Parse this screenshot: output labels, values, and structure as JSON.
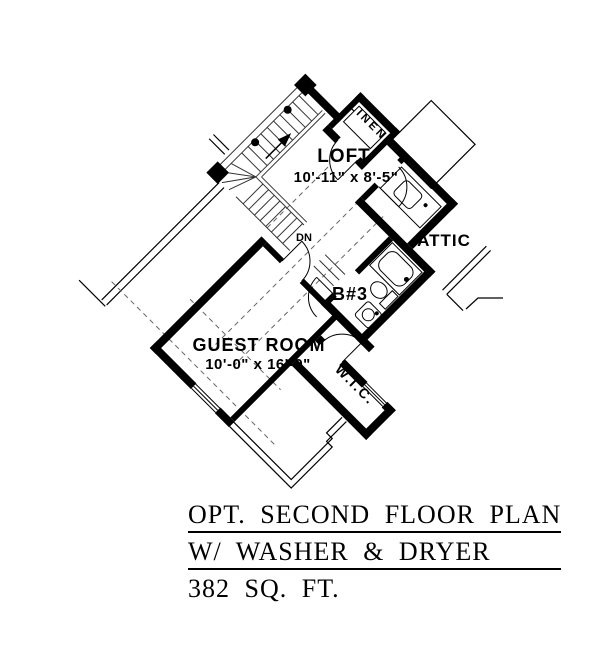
{
  "plan": {
    "rooms": {
      "loft": {
        "label": "LOFT",
        "dims": "10'-11\" x 8'-5\""
      },
      "guest_room": {
        "label": "GUEST ROOM",
        "dims": "10'-0\" x 16'-0\""
      },
      "attic": {
        "label": "ATTIC"
      },
      "bathroom": {
        "label": "B#3"
      },
      "wic": {
        "label": "W.I.C."
      },
      "linen": {
        "label": "LINEN"
      }
    },
    "stairs": {
      "down_label": "DN"
    }
  },
  "title_block": {
    "line1": "OPT. SECOND FLOOR PLAN",
    "line2": "W/ WASHER & DRYER",
    "line3": "382 SQ. FT."
  },
  "colors": {
    "ink": "#000000",
    "background": "#ffffff"
  }
}
